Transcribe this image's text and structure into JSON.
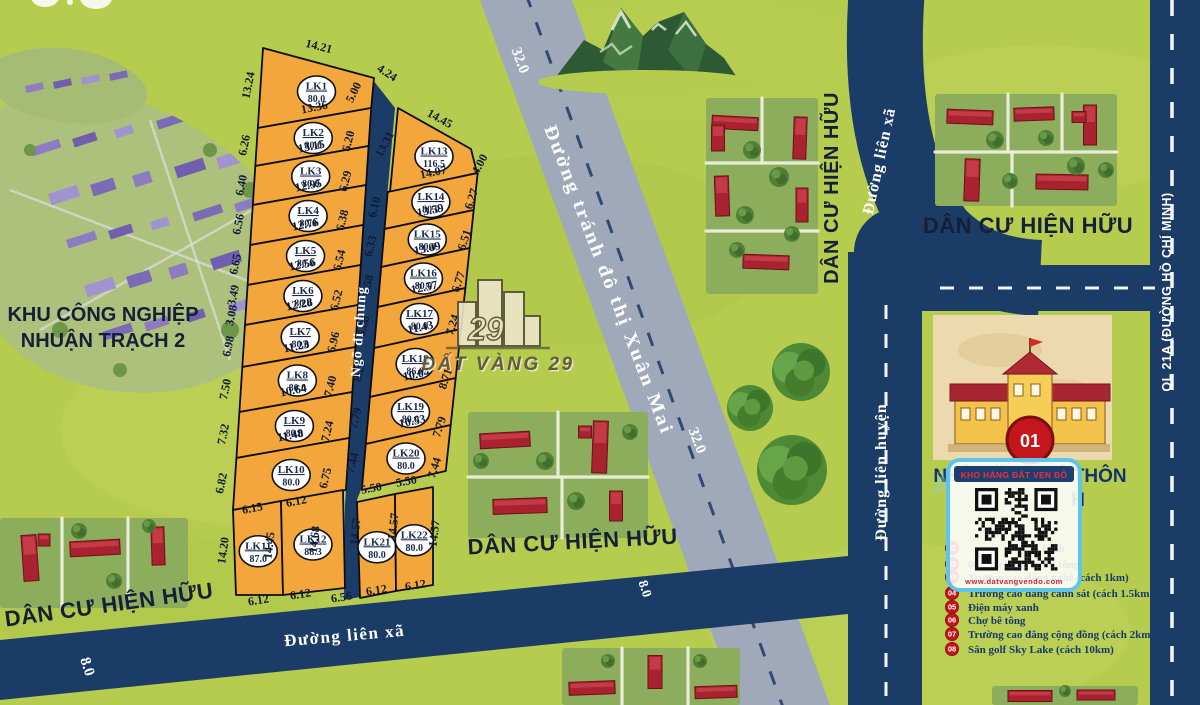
{
  "map": {
    "watermark": {
      "brand": "ĐẤT VÀNG 29",
      "logo_number": "29"
    },
    "roads": {
      "bypass": {
        "name": "Đường tránh đô thị Xuân Mai",
        "width_labels": [
          "32.0",
          "32.0"
        ]
      },
      "lien_xa_bottom": {
        "name": "Đường liên xã",
        "width_labels": [
          "8.0",
          "8.0"
        ]
      },
      "lien_xa_right": {
        "name": "Đường liên xã"
      },
      "lien_huyen": {
        "name": "Đường liên huyện"
      },
      "ql21a": {
        "name": "QL 21A (ĐƯỜNG HỒ CHÍ MINH)"
      }
    },
    "areas": {
      "industrial": {
        "line1": "KHU CÔNG NGHIỆP",
        "line2": "NHUẬN TRẠCH 2"
      },
      "residential_label": "DÂN CƯ HIỆN HỮU",
      "community_house": {
        "line1": "NHÀ VĂN HOÁ THÔN",
        "line2": "H",
        "ghost": "À VĂN HOÁ"
      },
      "school_badge": "01"
    },
    "alley": {
      "name": "Ngõ đi chung"
    },
    "plots": [
      {
        "id": "LK1",
        "area": "80.0"
      },
      {
        "id": "LK2",
        "area": "80.0"
      },
      {
        "id": "LK3",
        "area": "80.0"
      },
      {
        "id": "LK4",
        "area": "80.0"
      },
      {
        "id": "LK5",
        "area": "80.0"
      },
      {
        "id": "LK6",
        "area": "80.0"
      },
      {
        "id": "LK7",
        "area": "80.0"
      },
      {
        "id": "LK8",
        "area": "80.0"
      },
      {
        "id": "LK9",
        "area": "80.0"
      },
      {
        "id": "LK10",
        "area": "80.0"
      },
      {
        "id": "LK11",
        "area": "87.0"
      },
      {
        "id": "LK12",
        "area": "88.3"
      },
      {
        "id": "LK13",
        "area": "116.5"
      },
      {
        "id": "LK14",
        "area": "80.0"
      },
      {
        "id": "LK15",
        "area": "80.0"
      },
      {
        "id": "LK16",
        "area": "80.0"
      },
      {
        "id": "LK17",
        "area": "80.0"
      },
      {
        "id": "LK18",
        "area": "86.0"
      },
      {
        "id": "LK19",
        "area": "80.0"
      },
      {
        "id": "LK20",
        "area": "80.0"
      },
      {
        "id": "LK21",
        "area": "80.0"
      },
      {
        "id": "LK22",
        "area": "80.0"
      }
    ],
    "measurements": [
      "14.21",
      "13.24",
      "4.24",
      "5.00",
      "14.45",
      "4.00",
      "6.26",
      "6.40",
      "6.56",
      "6.65",
      "3.49",
      "3.08",
      "6.98",
      "7.50",
      "7.32",
      "6.82",
      "14.20",
      "13.36",
      "13.15",
      "12.95",
      "12.76",
      "12.56",
      "12.28",
      "11.23",
      "10.64",
      "11.48",
      "6.15",
      "6.12",
      "6.20",
      "6.29",
      "6.38",
      "6.54",
      "6.52",
      "6.96",
      "7.40",
      "7.24",
      "6.75",
      "14.45",
      "14.68",
      "6.12",
      "6.12",
      "6.56",
      "6.12",
      "6.12",
      "13.31",
      "6.10",
      "6.33",
      "6.58",
      "6.88",
      "8.23",
      "7.79",
      "7.44",
      "14.57",
      "14.57",
      "14.57",
      "14.07",
      "13.59",
      "13.09",
      "12.57",
      "11.43",
      "10.04",
      "10.53",
      "5.50",
      "5.50",
      "6.27",
      "6.51",
      "6.77",
      "7.24",
      "8.71",
      "7.79",
      "7.44"
    ],
    "legend": {
      "items": [
        {
          "num": "01",
          "text": "Linh"
        },
        {
          "num": "02",
          "text": "08 toà chung cư bê tông"
        },
        {
          "num": "03",
          "text": "Trường cao đẳng nghề (cách 1km)"
        },
        {
          "num": "04",
          "text": "Trường cao đẳng cảnh sát (cách 1.5km)"
        },
        {
          "num": "05",
          "text": "Điện máy xanh"
        },
        {
          "num": "06",
          "text": "Chợ bê tông"
        },
        {
          "num": "07",
          "text": "Trường cao đẳng cộng đồng (cách 2km)"
        },
        {
          "num": "08",
          "text": "Sân golf Sky Lake (cách 10km)"
        }
      ]
    },
    "qr": {
      "header": "KHO HÀNG ĐẤT VEN ĐÔ",
      "url": "www.datvangvendo.com"
    },
    "colors": {
      "grass": "#b6cc4e",
      "road_navy": "#1c3c68",
      "road_gray": "#9fa9ba",
      "plot": "#f2a63b",
      "badge_red": "#c5161d"
    }
  }
}
